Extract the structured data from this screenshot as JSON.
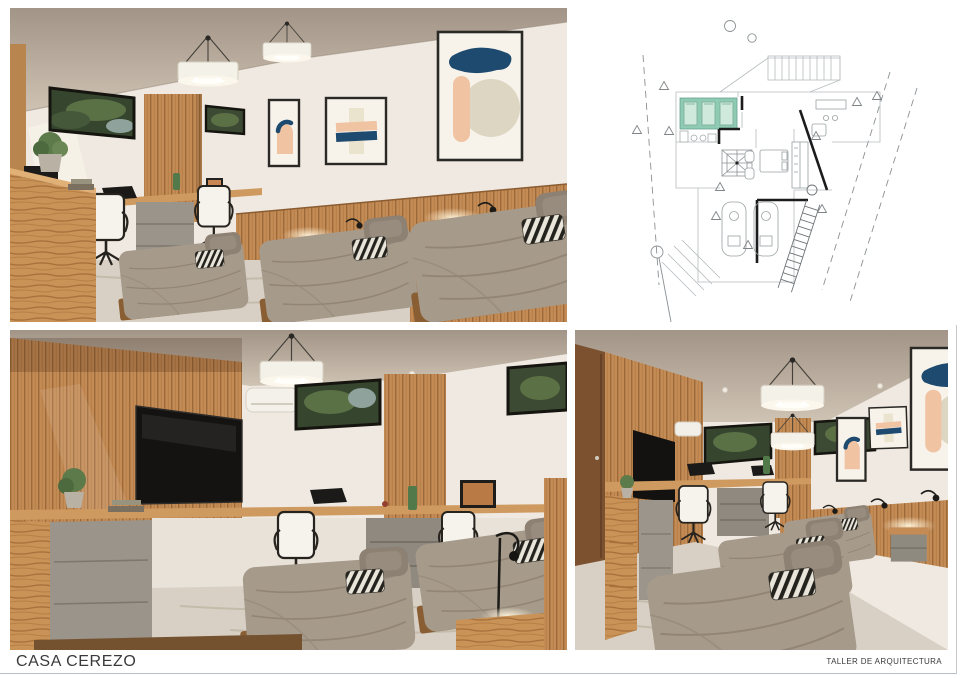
{
  "sheet": {
    "project_title": "CASA CEREZO",
    "studio_label": "TALLER DE ARQUITECTURA"
  },
  "panels": {
    "top_left_render": "Shared bedroom render - three beds, desk area and abstract wall art",
    "floor_plan": "Floor plan - shared bedroom highlighted in teal",
    "bottom_left_render": "Shared bedroom render - wood slat TV wall with built-in desks",
    "bottom_right_render": "Shared bedroom render - lengthwise view with three beds and desks"
  },
  "colors": {
    "ink": "#3a3a3a",
    "wood": "#c48b55",
    "wall": "#efe9e1",
    "ceiling": "#b4a798",
    "bedding": "#a69a8b",
    "floor_marble": "#d8d0c4",
    "drawer_gray": "#98928a",
    "art_navy": "#1d4a6e",
    "art_peach": "#f0c3a3",
    "plan_teal": "#8fcbb4"
  }
}
